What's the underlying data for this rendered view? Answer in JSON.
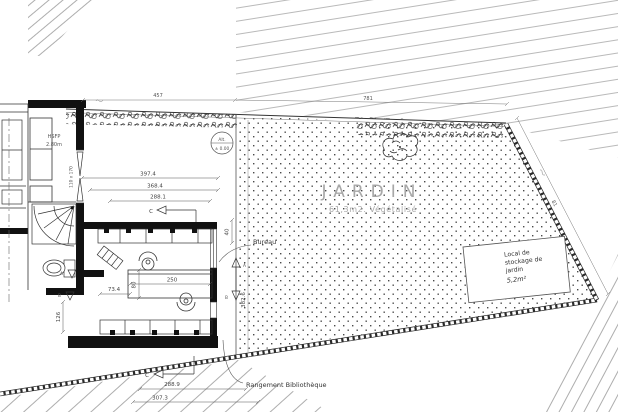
{
  "plan": {
    "labels": {
      "jardin_title": "JARDIN",
      "jardin_subtitle": "61,3m2. Végétalisé",
      "bureau": "Bureau",
      "rangement": "Rangement Bibliothèque",
      "local_line1": "Local de",
      "local_line2": "stockage de",
      "local_line3": "jardin",
      "local_area": "5,2m²",
      "hsfp": "HSFP",
      "hsfp_height": "2.80m",
      "window_size": "110 x 170",
      "alt_top": "Alt.",
      "alt_bottom": "± 0.00"
    },
    "dims": {
      "terrace_1": "397.4",
      "terrace_2": "368.4",
      "terrace_3": "288.1",
      "bottom_1": "288.9",
      "bottom_2": "307.3",
      "desk_width": "250",
      "desk_offset": "73.4",
      "desk_depth": "80",
      "garden_top": "40",
      "garden_depth": "382.6",
      "wall_opening": "126",
      "top_run_1": "457",
      "top_run_2": "781",
      "right_run": "81"
    },
    "markers": {
      "c": "C",
      "a": "A",
      "b": "B"
    },
    "colors": {
      "line": "#1a1a1a",
      "dim": "#555555",
      "light": "#a8a8a8",
      "dot": "#4a4a4a"
    }
  }
}
